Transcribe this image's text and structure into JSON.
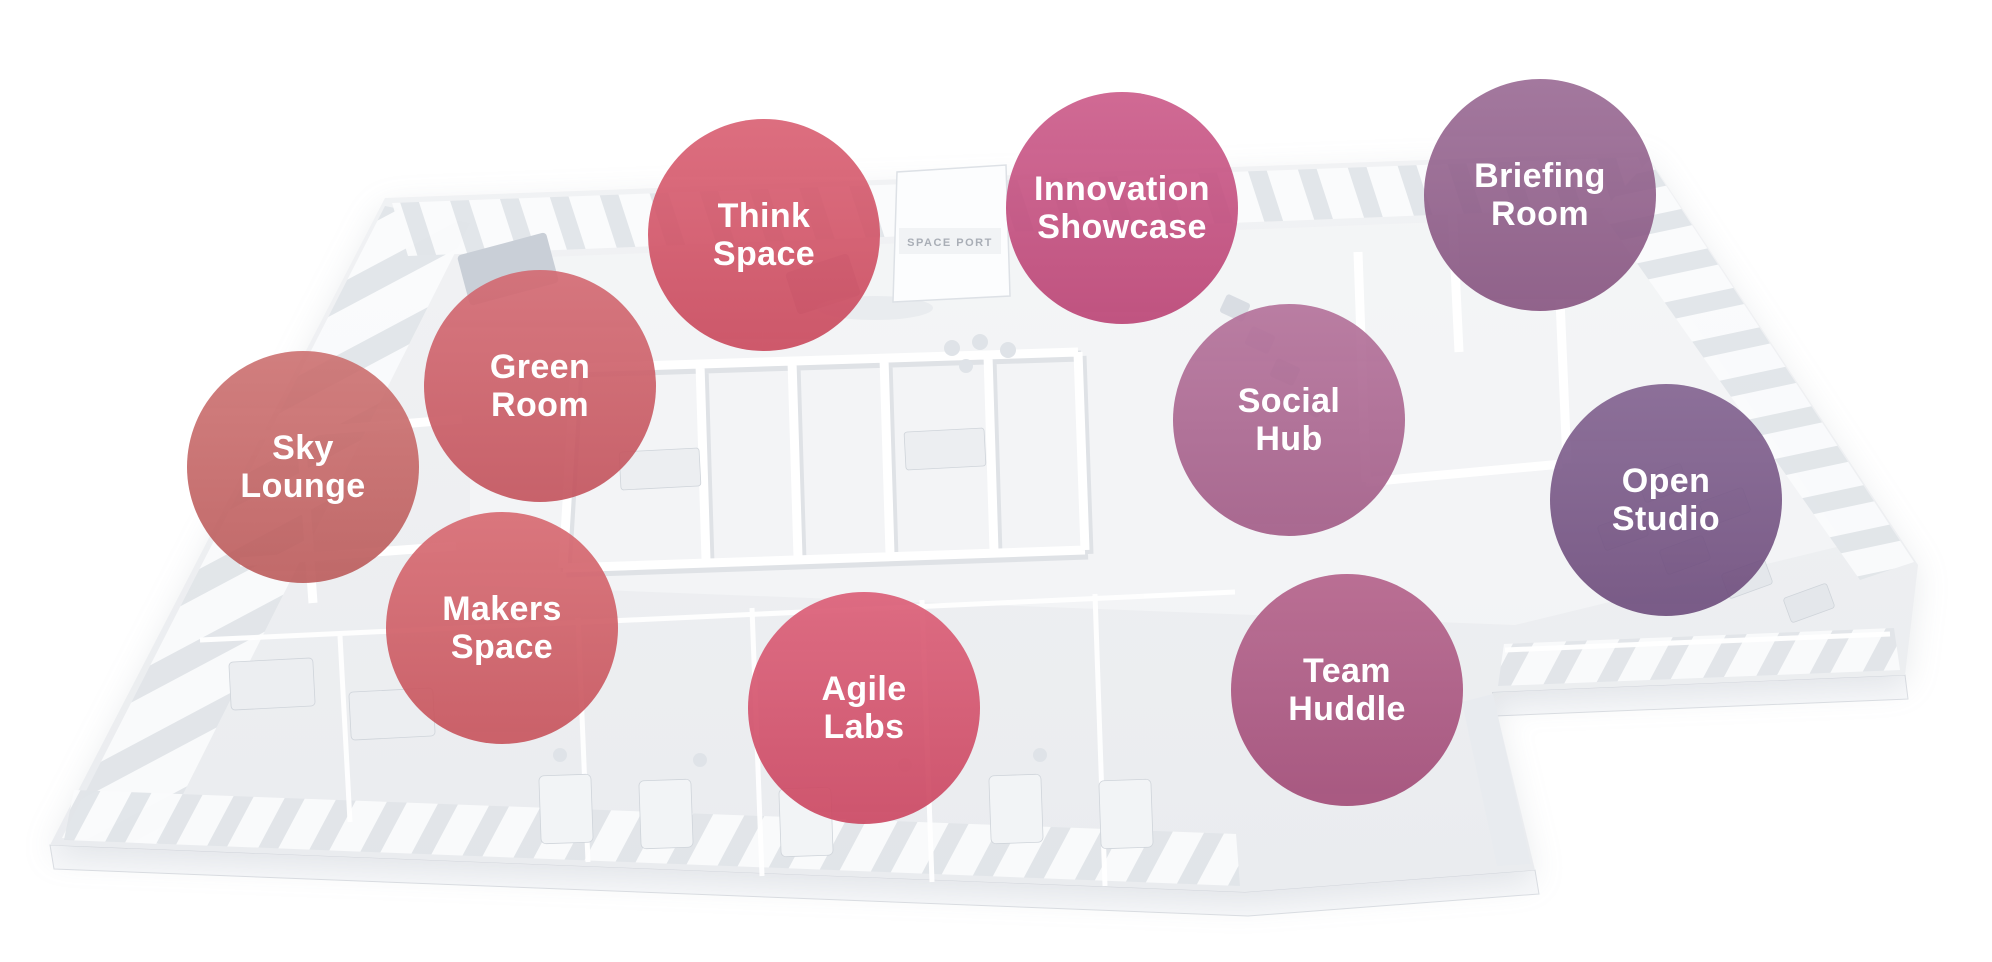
{
  "floorplan": {
    "background": "#ffffff",
    "booth_sign": "SPACE PORT"
  },
  "label_text_color": "#ffffff",
  "zones": [
    {
      "name": "Sky Lounge",
      "lines": [
        "Sky",
        "Lounge"
      ],
      "color": "#C65E5E"
    },
    {
      "name": "Green Room",
      "lines": [
        "Green",
        "Room"
      ],
      "color": "#CE555F"
    },
    {
      "name": "Think Space",
      "lines": [
        "Think",
        "Space"
      ],
      "color": "#D44A60"
    },
    {
      "name": "Makers Space",
      "lines": [
        "Makers",
        "Space"
      ],
      "color": "#D2555E"
    },
    {
      "name": "Agile Labs",
      "lines": [
        "Agile",
        "Labs"
      ],
      "color": "#D64864"
    },
    {
      "name": "Innovation Showcase",
      "lines": [
        "Innovation",
        "Showcase"
      ],
      "color": "#C54579"
    },
    {
      "name": "Social Hub",
      "lines": [
        "Social",
        "Hub"
      ],
      "color": "#AA5E8C"
    },
    {
      "name": "Team Huddle",
      "lines": [
        "Team",
        "Huddle"
      ],
      "color": "#AA4C7A"
    },
    {
      "name": "Briefing Room",
      "lines": [
        "Briefing",
        "Room"
      ],
      "color": "#8C5786"
    },
    {
      "name": "Open Studio",
      "lines": [
        "Open",
        "Studio"
      ],
      "color": "#714D81"
    }
  ]
}
